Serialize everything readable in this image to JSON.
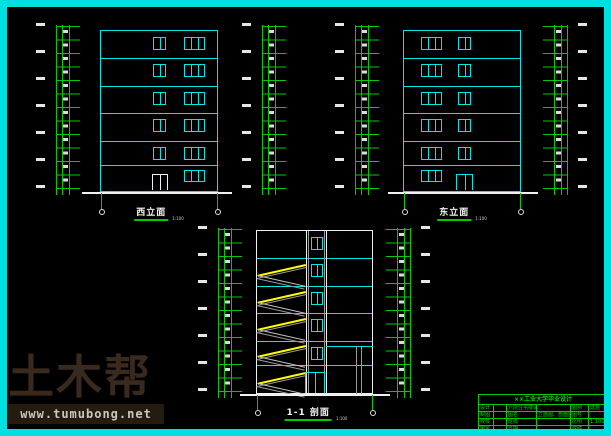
{
  "drawings": {
    "west": {
      "label": "西立面",
      "scale": "1:100"
    },
    "east": {
      "label": "东立面",
      "scale": "1:100"
    },
    "section": {
      "label": "1-1 剖面",
      "scale": "1:100"
    }
  },
  "watermark": {
    "brand": "土木帮",
    "url": "www.tumubong.net"
  },
  "title_block": {
    "header": "××工业大学毕业设计",
    "rows": [
      [
        "设计",
        "",
        "六层住宅楼设计",
        "",
        "图别",
        "建施"
      ],
      [
        "制图",
        "",
        "图名",
        "立面图、剖面图",
        "图号",
        ""
      ],
      [
        "校核",
        "",
        "班级",
        "",
        "比例",
        "1:100"
      ],
      [
        "审定",
        "",
        "日期",
        "",
        "成绩",
        ""
      ]
    ]
  },
  "colors": {
    "border_cyan": "#00dfdf",
    "line_cyan": "#00e8e8",
    "line_green": "#00cc00",
    "line_white": "#f0f0f0",
    "stair_yellow": "#ffff00",
    "stair_gray": "#9a9a9a",
    "watermark_brown": "#3a2a1e",
    "titleblock_green": "#00dd00"
  }
}
